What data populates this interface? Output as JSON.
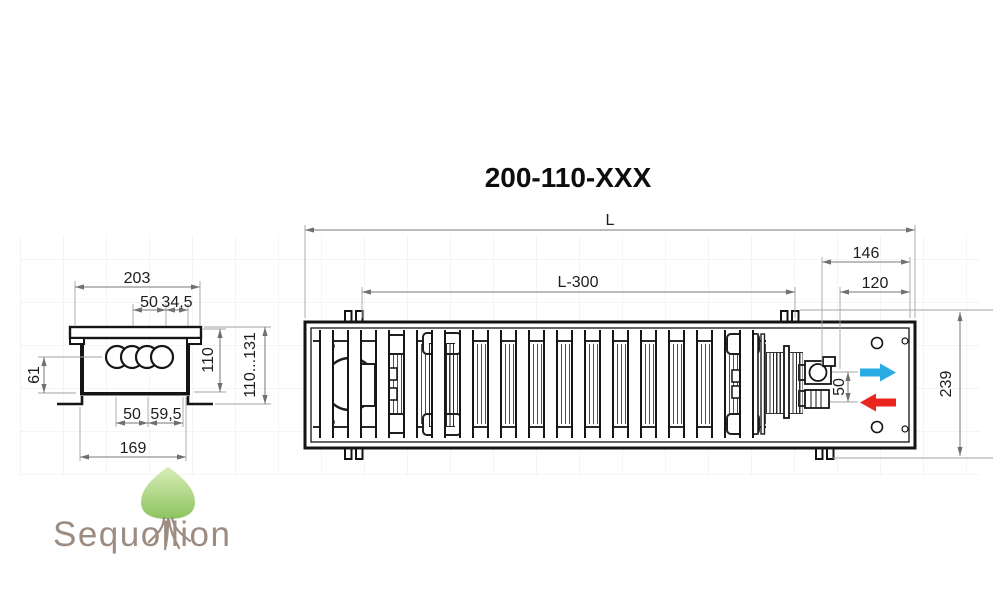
{
  "title": "200-110-XXX",
  "side_view": {
    "dims": {
      "top_width": "203",
      "tube_pitch_top": "50",
      "tube_edge_top": "34,5",
      "depth_left": "61",
      "body_height": "110",
      "height_range": "110...131",
      "tube_pitch_bottom": "50",
      "tube_edge_bottom": "59,5",
      "base_width": "169"
    }
  },
  "plan_view": {
    "dims": {
      "length_overall": "L",
      "grille_length": "L-300",
      "connection_box": "146",
      "connection_inner": "120",
      "pipe_spacing": "50",
      "width_overall": "239"
    },
    "icons": {
      "supply_flow": "right-arrow",
      "return_flow": "left-arrow"
    }
  },
  "logo": {
    "text": "Sequollion",
    "icon": "tree"
  },
  "colors": {
    "supply_blue": "#29ace3",
    "return_red": "#e8251e",
    "leaf_green_light": "#d6ecb4",
    "leaf_green_dark": "#8cc45f",
    "logo_taupe": "#9d8c81",
    "outline_dark": "#151515",
    "dimension_gray": "#777777"
  }
}
